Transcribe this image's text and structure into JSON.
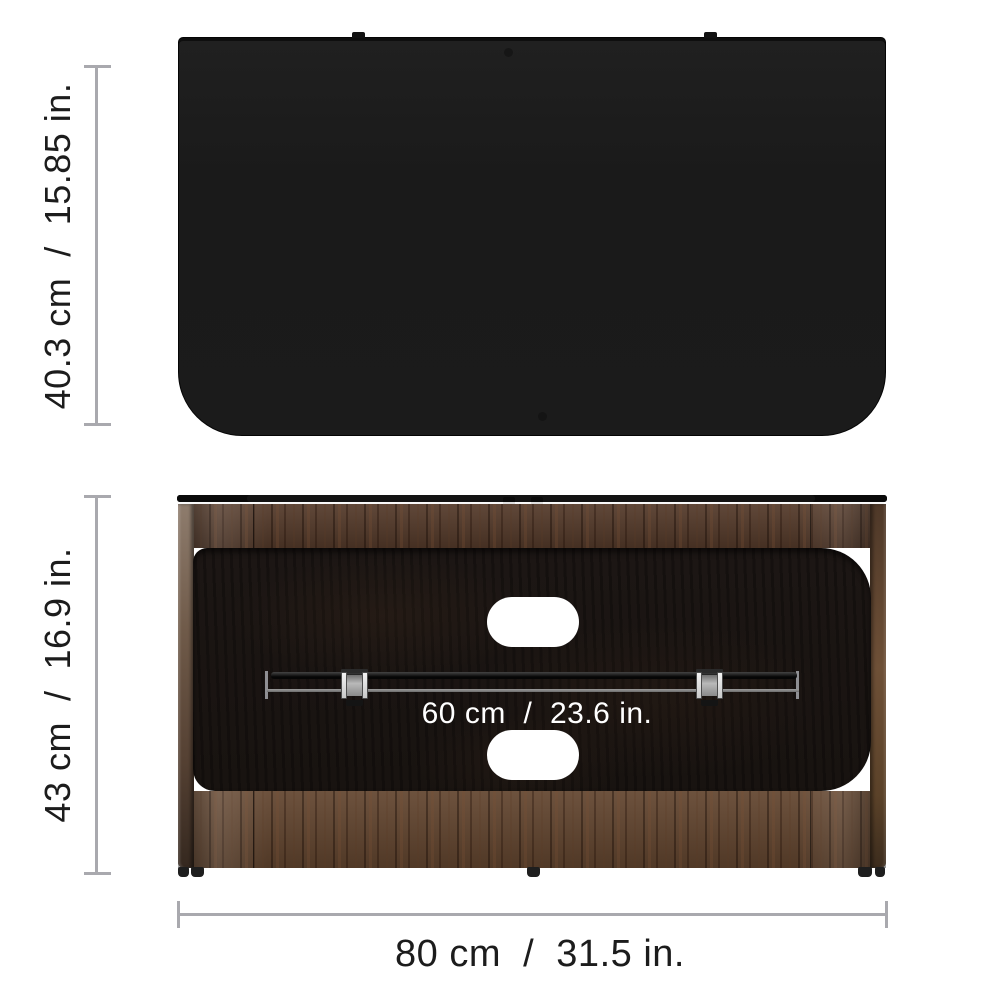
{
  "canvas": {
    "width": 1000,
    "height": 1000,
    "background": "#ffffff"
  },
  "views": {
    "top": {
      "name": "tv-stand-top-view-silhouette",
      "depth_label": "40.3 cm  /  15.85 in."
    },
    "front": {
      "name": "tv-stand-back-view",
      "height_label": "43 cm  /  16.9 in.",
      "width_label": "80 cm  /  31.5 in.",
      "inner_width_label": "60 cm  /  23.6 in.",
      "cutout_count": 2,
      "cable_clamp_count": 2
    }
  },
  "colors": {
    "dimension_line": "#a9a9ae",
    "label_text": "#1c1c1c",
    "inner_label_text": "#ffffff",
    "silhouette": "#1b1b1b",
    "wood_mid": "#543a2a",
    "wood_bottom_band": "#62452f",
    "back_panel": "#1a1412",
    "cutout": "#ffffff"
  }
}
